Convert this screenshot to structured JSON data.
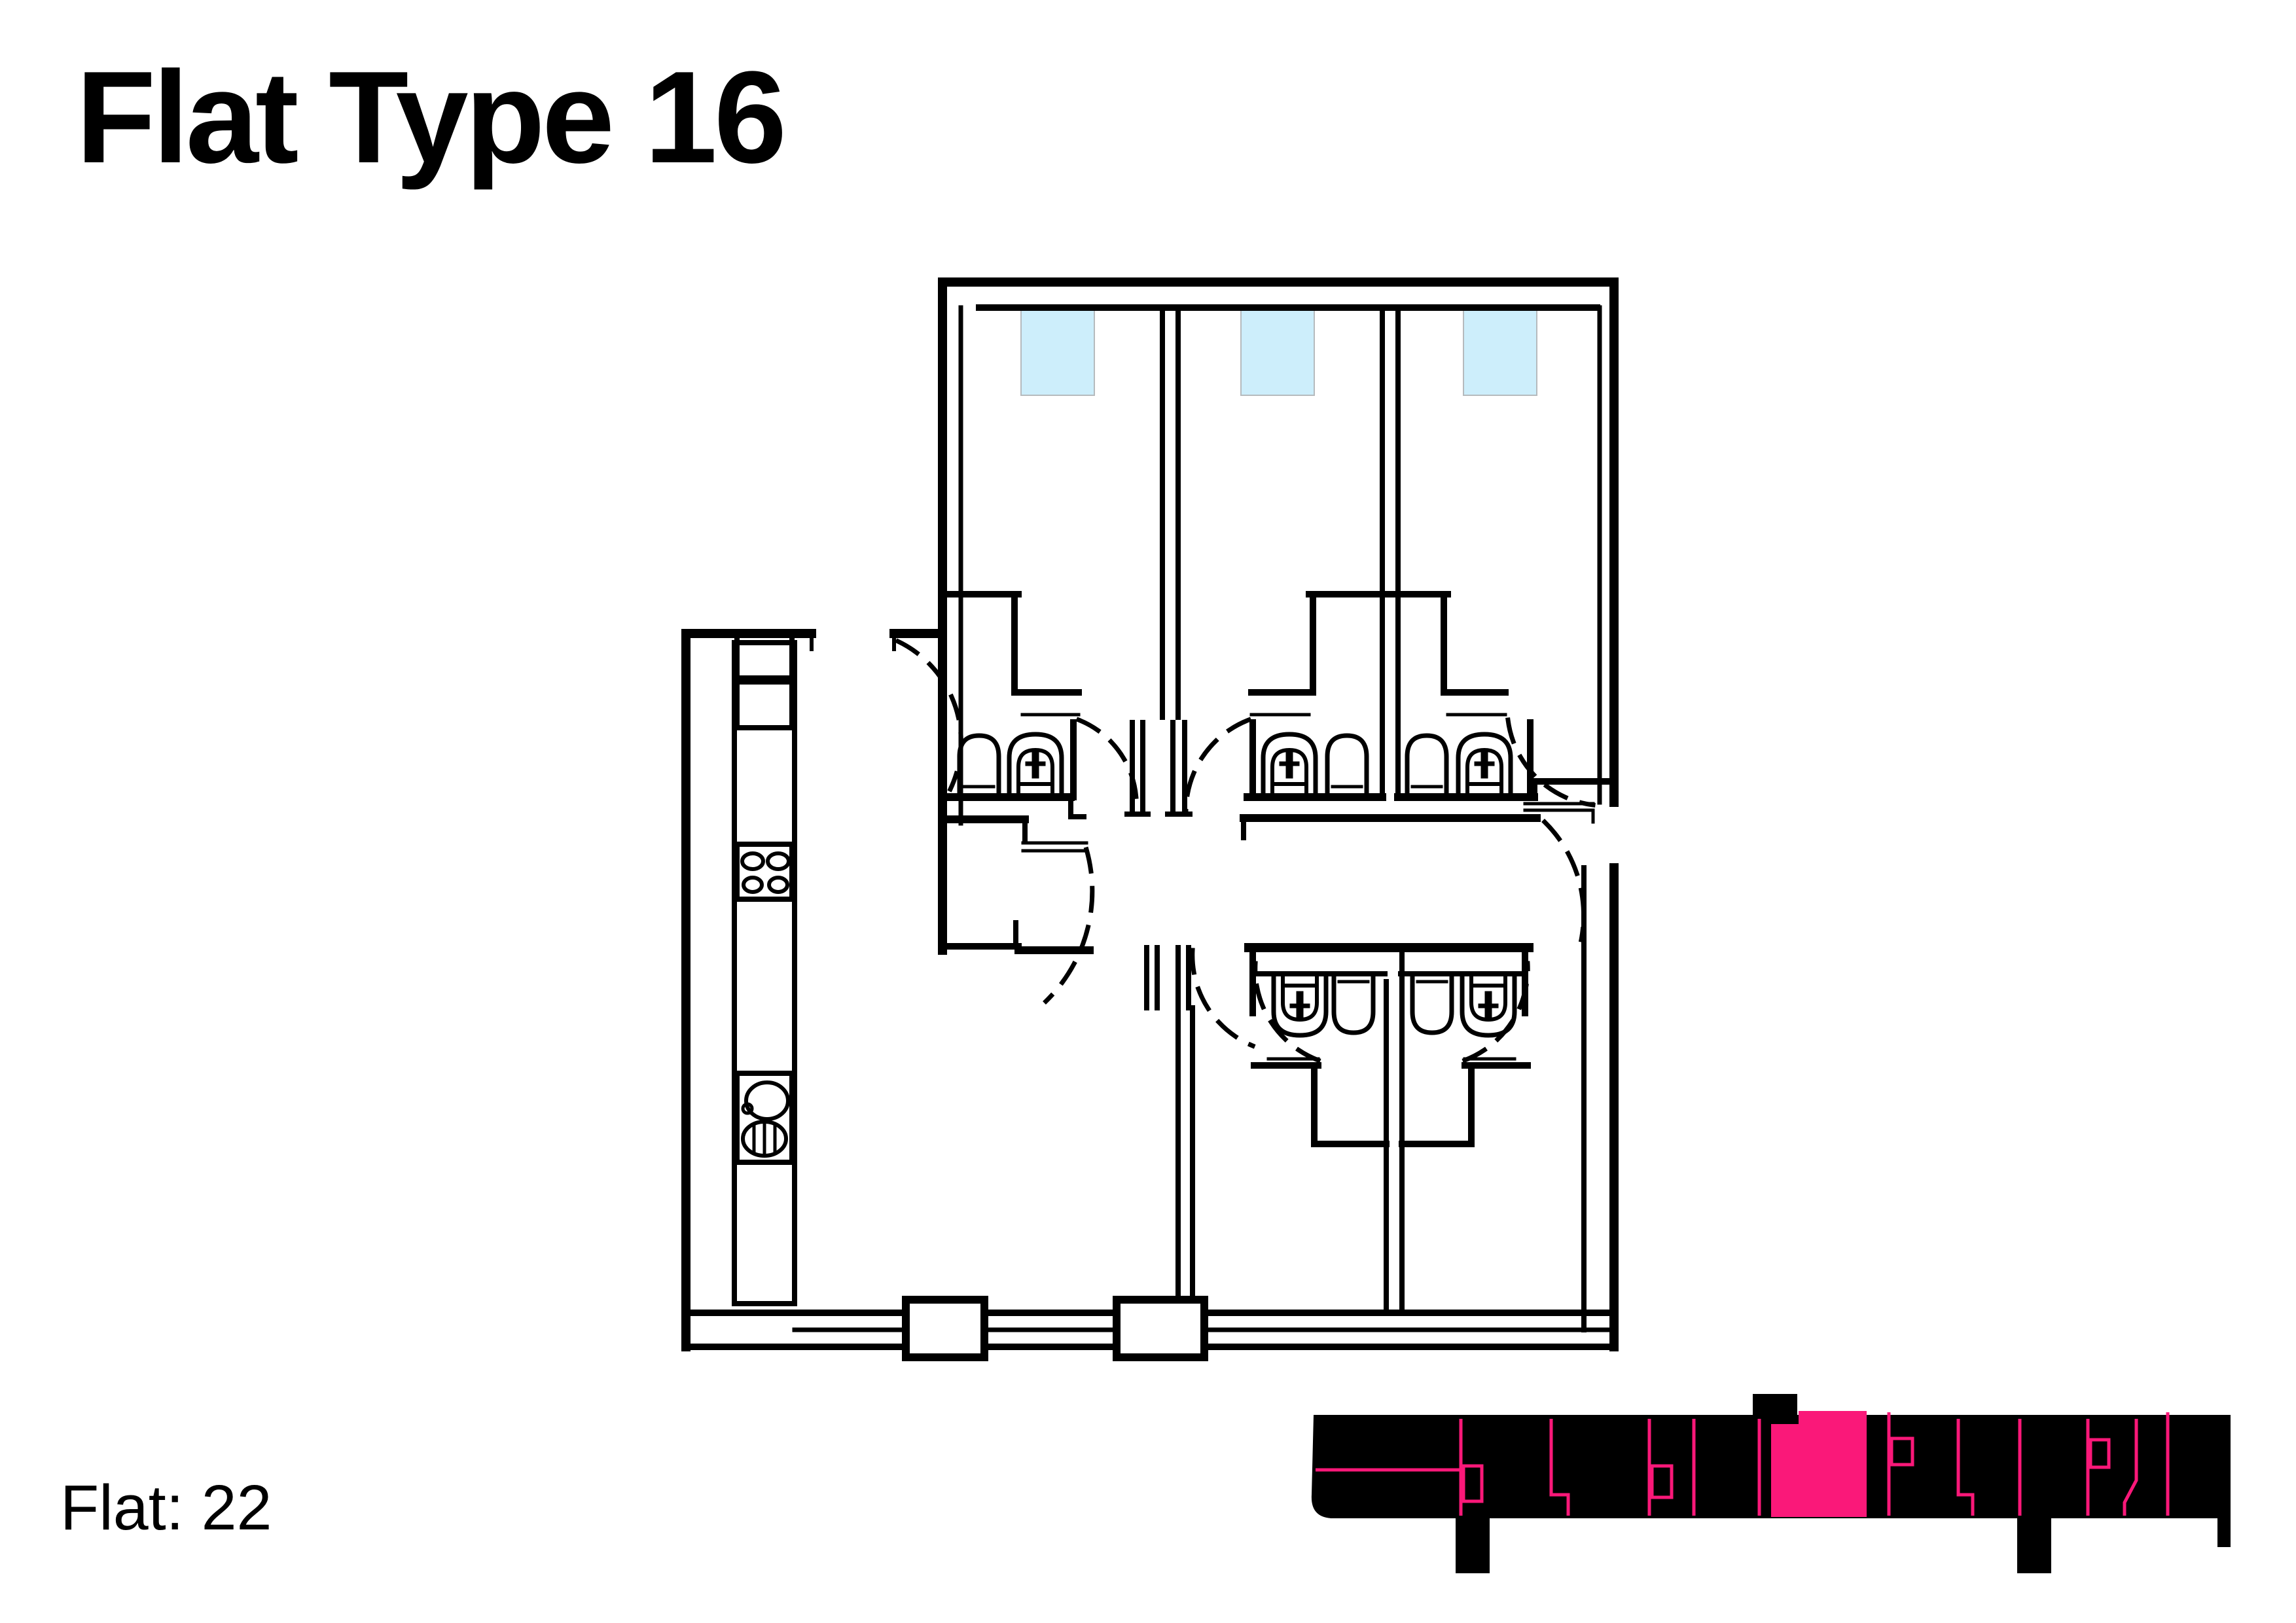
{
  "page": {
    "title": "Flat Type 16",
    "flat_label": "Flat: 22",
    "background": "#ffffff"
  },
  "colors": {
    "line": "#000000",
    "white": "#ffffff",
    "highlight_pink": "#fa1879",
    "window_blue": "#cdeefb",
    "window_border": "#b5babd"
  },
  "floor_plan": {
    "bedrooms": 3,
    "windows": 3,
    "ensuite_bathrooms": 3,
    "lower_bathrooms": 2,
    "toilets": 5,
    "basins": 5,
    "hob_burners": 4,
    "kitchen_sinks": 1
  },
  "key_plan": {
    "highlighted_unit": true,
    "position": "bottom-right"
  }
}
